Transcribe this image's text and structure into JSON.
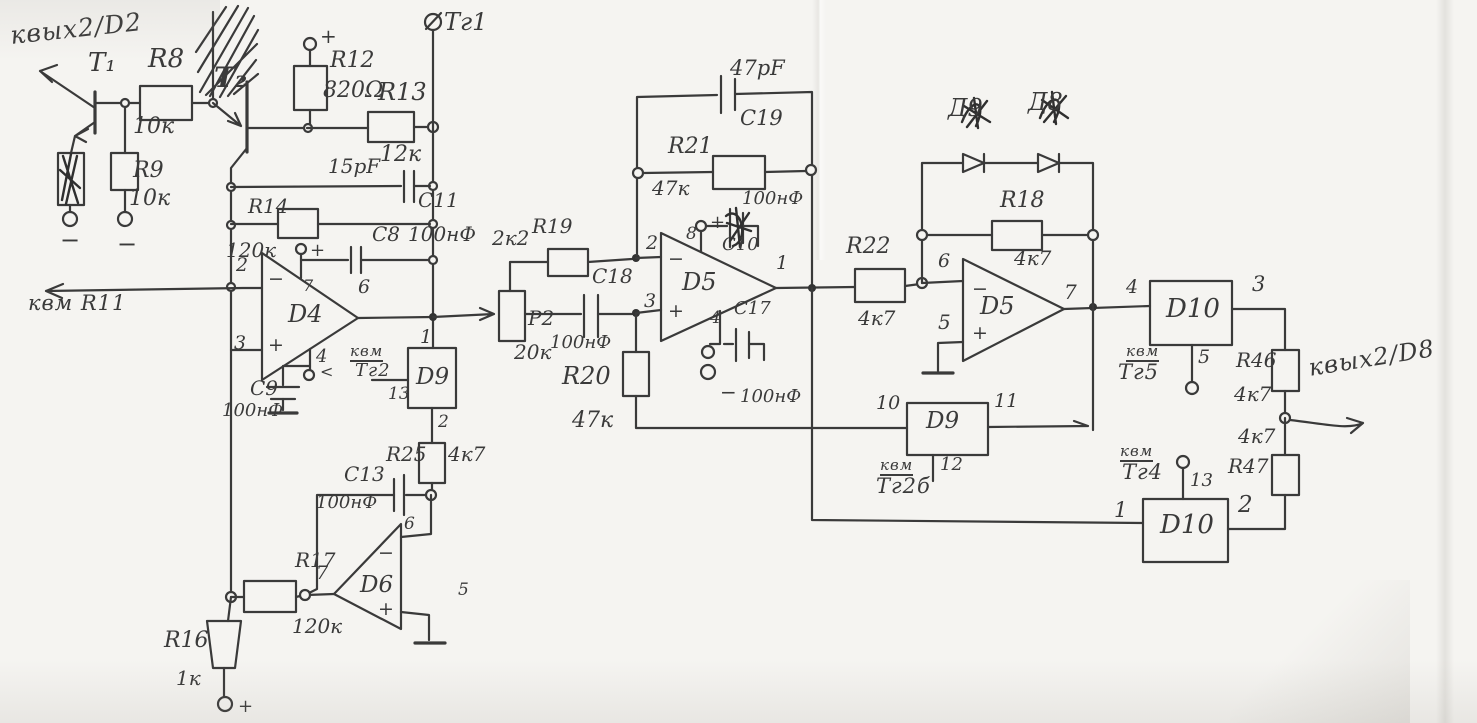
{
  "colors": {
    "ink": "#3a3a3a",
    "paper": "#f5f4f1"
  },
  "annotations": {
    "to_out2_d2": "квых2/D2",
    "to_r11": "квм R11",
    "to_out2_d8": "квых2/D8",
    "tg1": "Тг1",
    "tick": "<",
    "ref_tg2": {
      "l1": "квм",
      "l2": "Тг2"
    },
    "ref_tg2b": {
      "l1": "квм",
      "l2": "Тг2б"
    },
    "ref_tg4": {
      "l1": "квм",
      "l2": "Тг4"
    },
    "ref_tg5": {
      "l1": "квм",
      "l2": "Тг5"
    }
  },
  "signs": {
    "plus": "+",
    "minus": "−"
  },
  "transistors": {
    "t1": "T₁",
    "t2": "T₂"
  },
  "resistors": {
    "r8": {
      "name": "R8",
      "value": "10к"
    },
    "r9": {
      "name": "R9",
      "value": "10к"
    },
    "r12": {
      "name": "R12",
      "value": "820Ω"
    },
    "r13": {
      "name": "R13",
      "value": "12к"
    },
    "r14": {
      "name": "R14",
      "value": "120к"
    },
    "r16": {
      "name": "R16",
      "value": "1к"
    },
    "r17": {
      "name": "R17",
      "value": "120к"
    },
    "r18": {
      "name": "R18",
      "value": "4к7"
    },
    "r19": {
      "name": "R19",
      "value": "2к2"
    },
    "r20": {
      "name": "R20",
      "value": "47к"
    },
    "r21": {
      "name": "R21",
      "value": "47к"
    },
    "r22": {
      "name": "R22",
      "value": "4к7"
    },
    "r25": {
      "name": "R25",
      "value": "4к7"
    },
    "r46": {
      "name": "R46",
      "value": "4к7"
    },
    "r47": {
      "name": "R47",
      "value": "4к7"
    },
    "p2": {
      "name": "P2",
      "value": "20к"
    }
  },
  "capacitors": {
    "c8": {
      "name": "C8",
      "value": "100нФ"
    },
    "c9": {
      "name": "C9",
      "value": "100нФ"
    },
    "c10": {
      "name": "C10",
      "value": "100нФ"
    },
    "c11": {
      "name": "C11",
      "value": "15pF"
    },
    "c13": {
      "name": "C13",
      "value": "100нФ"
    },
    "c17": {
      "name": "C17",
      "value": "100нФ"
    },
    "c18": {
      "name": "C18",
      "value": "100нФ"
    },
    "c19": {
      "name": "C19",
      "value": "47pF"
    }
  },
  "opamps": {
    "d4": {
      "name": "D4",
      "pin_inv": "2",
      "pin_nin": "3",
      "pin_out": "6",
      "pin_vplus": "7",
      "pin_vminus": "4"
    },
    "d5a": {
      "name": "D5",
      "pin_inv": "2",
      "pin_nin": "3",
      "pin_out": "1",
      "pin_vplus": "8",
      "pin_vminus": "4"
    },
    "d5b": {
      "name": "D5",
      "pin_inv": "6",
      "pin_nin": "5",
      "pin_out": "7"
    },
    "d6": {
      "name": "D6",
      "pin_inv": "6",
      "pin_nin": "5",
      "pin_out": "7"
    }
  },
  "ics": {
    "d9a": {
      "name": "D9",
      "pin_top": "1",
      "pin_left": "13",
      "pin_bottom": "2"
    },
    "d9b": {
      "name": "D9",
      "pin_left": "10",
      "pin_right": "11",
      "pin_bottom": "12"
    },
    "d10a": {
      "name": "D10",
      "pin_left": "4",
      "pin_right": "3",
      "pin_bottom": "5"
    },
    "d10b": {
      "name": "D10",
      "pin_left": "1",
      "pin_right": "2",
      "pin_top": "13"
    }
  },
  "diodes": {
    "d9": "Д9",
    "d8": "Д8"
  }
}
